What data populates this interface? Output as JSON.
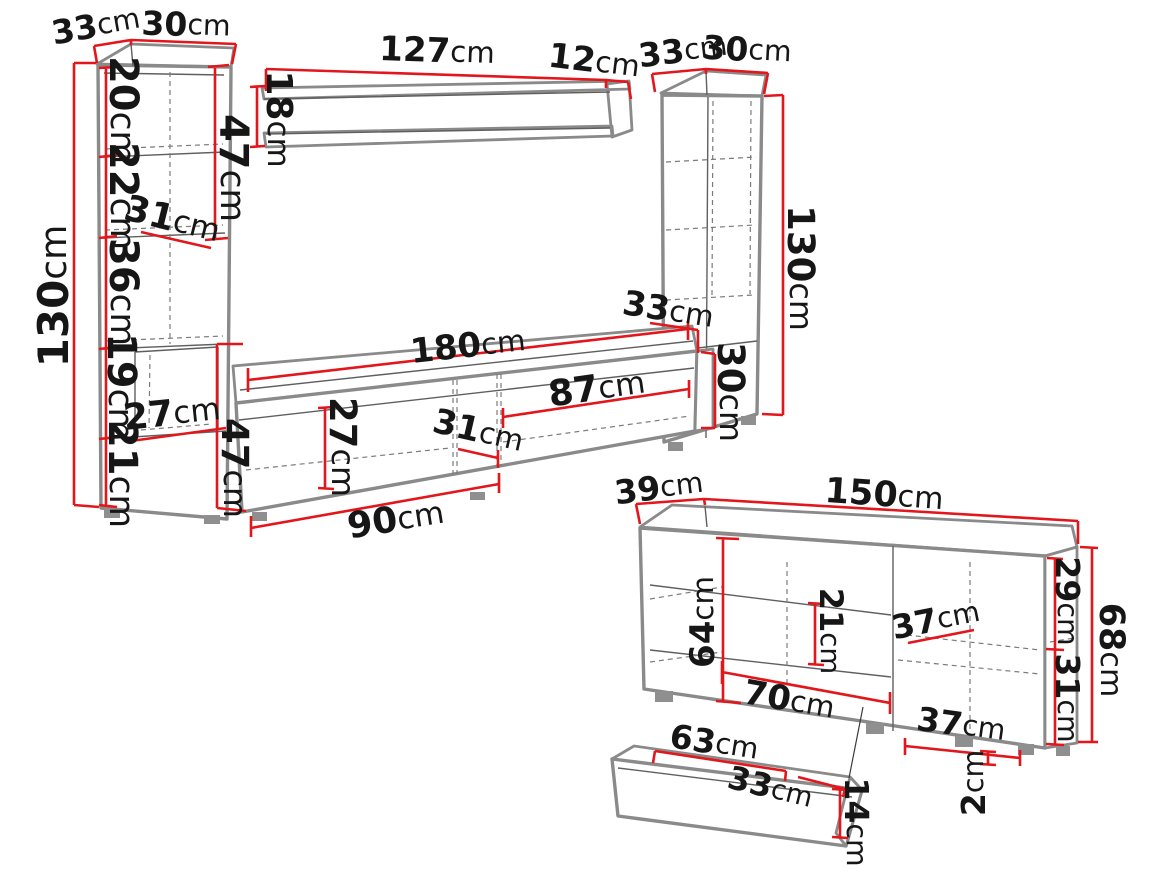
{
  "unit": "cm",
  "diagram_title": "wall unit and sideboard dimensions",
  "colors": {
    "dimension_line": "#e2161b",
    "furniture_outline": "#8a8a8a",
    "label_text": "#161616",
    "background": "#ffffff"
  },
  "pieces": {
    "left_cabinet": {
      "top_depth": "33",
      "top_width": "30",
      "height": "130",
      "section_1": "20",
      "section_2": "22",
      "section_3": "36",
      "section_4": "19",
      "section_5": "21",
      "shelf_depth": "31",
      "upper_door_height": "47",
      "niche_depth": "27"
    },
    "wall_shelf": {
      "length": "127",
      "end_width": "12",
      "height": "18"
    },
    "right_cabinet": {
      "top_depth": "33",
      "top_width": "30",
      "height": "130"
    },
    "tv_stand": {
      "length": "180",
      "right_section": "87",
      "inner_height": "27",
      "niche_width": "31",
      "left_section": "90",
      "height": "47",
      "depth": "33",
      "right_height": "30"
    },
    "sideboard": {
      "depth": "39",
      "width": "150",
      "inner_height": "64",
      "shelf_spacing": "21",
      "shelf_depth_upper": "37",
      "door_width": "70",
      "shelf_depth_lower": "37",
      "upper_section": "29",
      "lower_section": "31",
      "height": "68",
      "leg_height": "2"
    },
    "drawer": {
      "width": "63",
      "depth": "33",
      "height": "14"
    }
  }
}
